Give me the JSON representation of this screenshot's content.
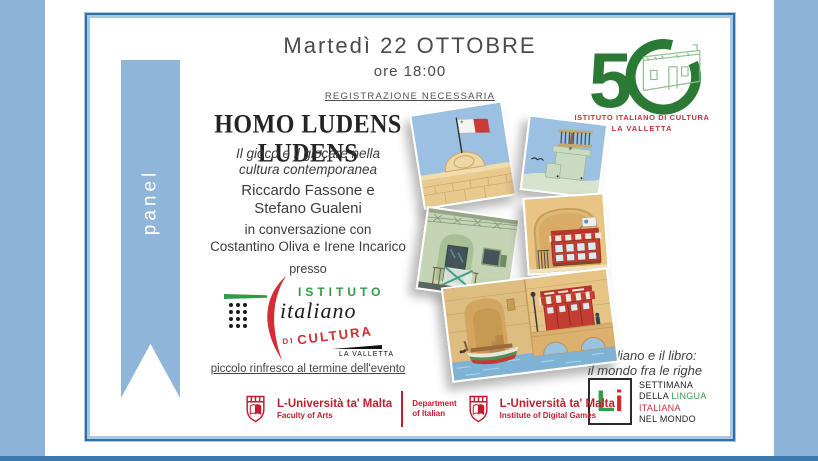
{
  "ribbon": {
    "label": "panel"
  },
  "header": {
    "date": "Martedì 22 OTTOBRE",
    "time": "ore 18:00",
    "registration": "REGISTRAZIONE NECESSARIA"
  },
  "event": {
    "title": "HOMO LUDENS LUDENS",
    "subtitle": [
      "Il gioco e il giocare nella",
      "cultura contemporanea"
    ],
    "speakers": [
      "Riccardo Fassone e",
      "Stefano Gualeni"
    ],
    "conversation": [
      "in conversazione con",
      "Costantino Oliva e Irene Incarico"
    ],
    "venue_intro": "presso",
    "closing_note": "piccolo rinfresco al termine dell'evento"
  },
  "iic_logo": {
    "istituto": "ISTITUTO",
    "italiano": "italiano",
    "di": "DI",
    "cultura": "CULTURA",
    "city": "LA VALLETTA"
  },
  "anniversary": {
    "number": "5",
    "caption_line1": "ISTITUTO ITALIANO DI CULTURA",
    "caption_line2": "LA VALLETTA"
  },
  "campaign": {
    "tagline": [
      "L'italiano e il libro:",
      "il mondo fra le righe"
    ],
    "li_l": "L",
    "li_i": "i",
    "week_line1": "SETTIMANA",
    "week_line2_a": "DELLA",
    "week_line2_b": "LINGUA",
    "week_line3": "ITALIANA",
    "week_line4": "NEL MONDO"
  },
  "partners": {
    "uni_name": "L-Università ta' Malta",
    "faculty": "Faculty of Arts",
    "department_line1": "Department",
    "department_line2": "of Italian",
    "uni2_name": "L-Università ta' Malta",
    "institute": "Institute of Digital Games"
  },
  "colors": {
    "band_blue": "#8BB3D7",
    "frame_dark": "#2F6FA3",
    "iic_green": "#2E9C47",
    "iic_red": "#D22C34",
    "anniversary_green": "#2A7A35",
    "uom_red": "#BF1E2E",
    "li_green": "#2F9E44",
    "li_red": "#D62828"
  }
}
